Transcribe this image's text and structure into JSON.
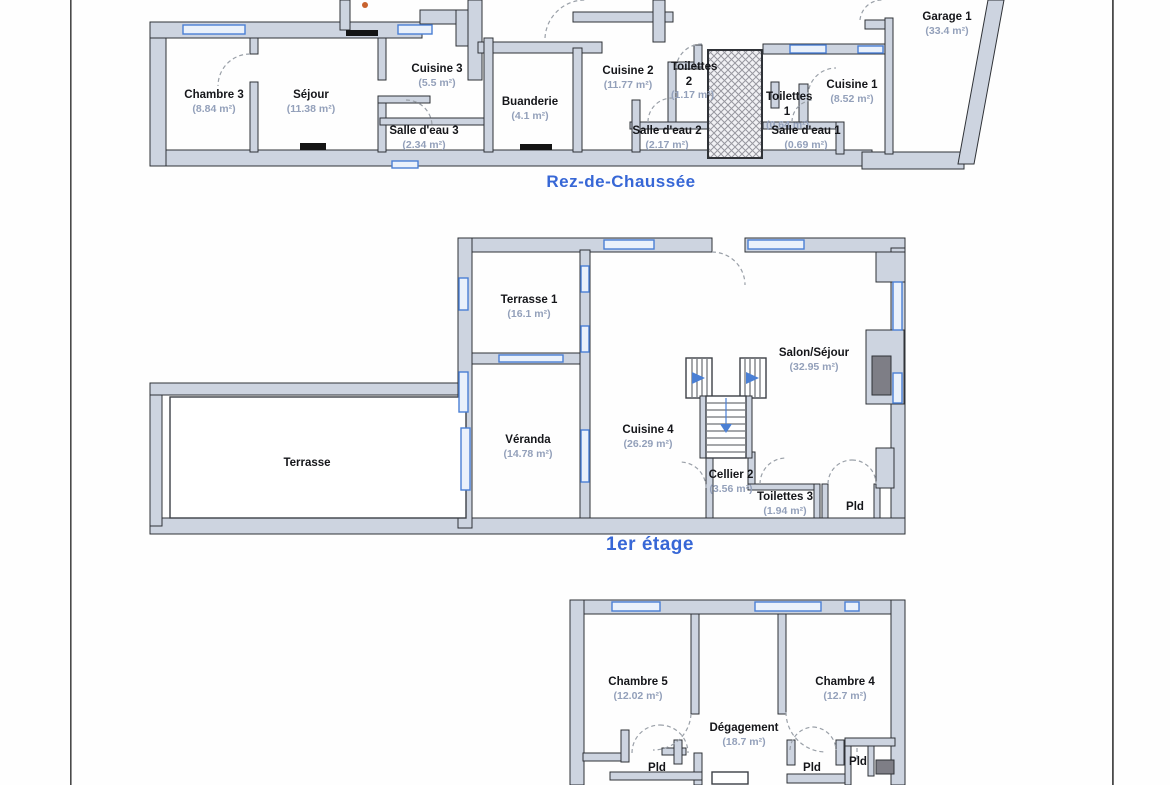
{
  "document": {
    "type": "floor-plan-scan",
    "language": "fr"
  },
  "colors": {
    "wall_fill": "#cdd4e0",
    "wall_stroke": "#2f3237",
    "window_blue": "#4a7fd4",
    "title_blue": "#3767d6",
    "area_text": "#93a0ba",
    "room_text": "#15161a",
    "fireplace_gray": "#7e7e86",
    "scan_dot_orange": "#c8622e"
  },
  "floors": [
    {
      "name": "rez-de-chaussee",
      "title": {
        "text": "Rez-de-Chaussée",
        "x": 621,
        "y": 172,
        "size": 17
      },
      "rooms": [
        {
          "label": "Chambre 3",
          "area": "(8.84 m²)",
          "x": 214,
          "y": 88
        },
        {
          "label": "Séjour",
          "area": "(11.38 m²)",
          "x": 311,
          "y": 88
        },
        {
          "label": "Cuisine 3",
          "area": "(5.5 m²)",
          "x": 437,
          "y": 62
        },
        {
          "label": "Salle d'eau 3",
          "area": "(2.34 m²)",
          "x": 424,
          "y": 124
        },
        {
          "label": "Buanderie",
          "area": "(4.1 m²)",
          "x": 530,
          "y": 95
        },
        {
          "label": "Cuisine 2",
          "area": "(11.77 m²)",
          "x": 628,
          "y": 64
        },
        {
          "label": "Toilettes 2",
          "area": "(1.17 m²)",
          "x": 689,
          "y": 60,
          "w": 36
        },
        {
          "label": "Salle d'eau 2",
          "area": "(2.17 m²)",
          "x": 667,
          "y": 124
        },
        {
          "label": "Toilettes 1",
          "area": "(0.64 m²)",
          "x": 787,
          "y": 90,
          "w": 42
        },
        {
          "label": "Salle d'eau 1",
          "area": "(0.69 m²)",
          "x": 806,
          "y": 124
        },
        {
          "label": "Cuisine 1",
          "area": "(8.52 m²)",
          "x": 852,
          "y": 78
        },
        {
          "label": "Garage 1",
          "area": "(33.4 m²)",
          "x": 947,
          "y": 10
        }
      ]
    },
    {
      "name": "premier-etage",
      "title": {
        "text": "1er étage",
        "x": 650,
        "y": 534,
        "size": 19
      },
      "rooms": [
        {
          "label": "Terrasse 1",
          "area": "(16.1 m²)",
          "x": 529,
          "y": 293
        },
        {
          "label": "Salon/Séjour",
          "area": "(32.95 m²)",
          "x": 814,
          "y": 346
        },
        {
          "label": "Terrasse",
          "area": "",
          "x": 307,
          "y": 456
        },
        {
          "label": "Véranda",
          "area": "(14.78 m²)",
          "x": 528,
          "y": 433
        },
        {
          "label": "Cuisine 4",
          "area": "(26.29 m²)",
          "x": 648,
          "y": 423
        },
        {
          "label": "Cellier 2",
          "area": "(3.56 m²)",
          "x": 731,
          "y": 468
        },
        {
          "label": "Toilettes 3",
          "area": "(1.94 m²)",
          "x": 785,
          "y": 490
        },
        {
          "label": "Pld",
          "area": "",
          "x": 855,
          "y": 500
        }
      ]
    },
    {
      "name": "etage-superieur",
      "title": null,
      "rooms": [
        {
          "label": "Chambre 5",
          "area": "(12.02 m²)",
          "x": 638,
          "y": 675
        },
        {
          "label": "Chambre 4",
          "area": "(12.7 m²)",
          "x": 845,
          "y": 675
        },
        {
          "label": "Dégagement",
          "area": "(18.7 m²)",
          "x": 744,
          "y": 721
        },
        {
          "label": "Pld",
          "area": "",
          "x": 657,
          "y": 761
        },
        {
          "label": "Pld",
          "area": "",
          "x": 812,
          "y": 761
        },
        {
          "label": "Pld",
          "area": "",
          "x": 858,
          "y": 755
        }
      ]
    }
  ]
}
